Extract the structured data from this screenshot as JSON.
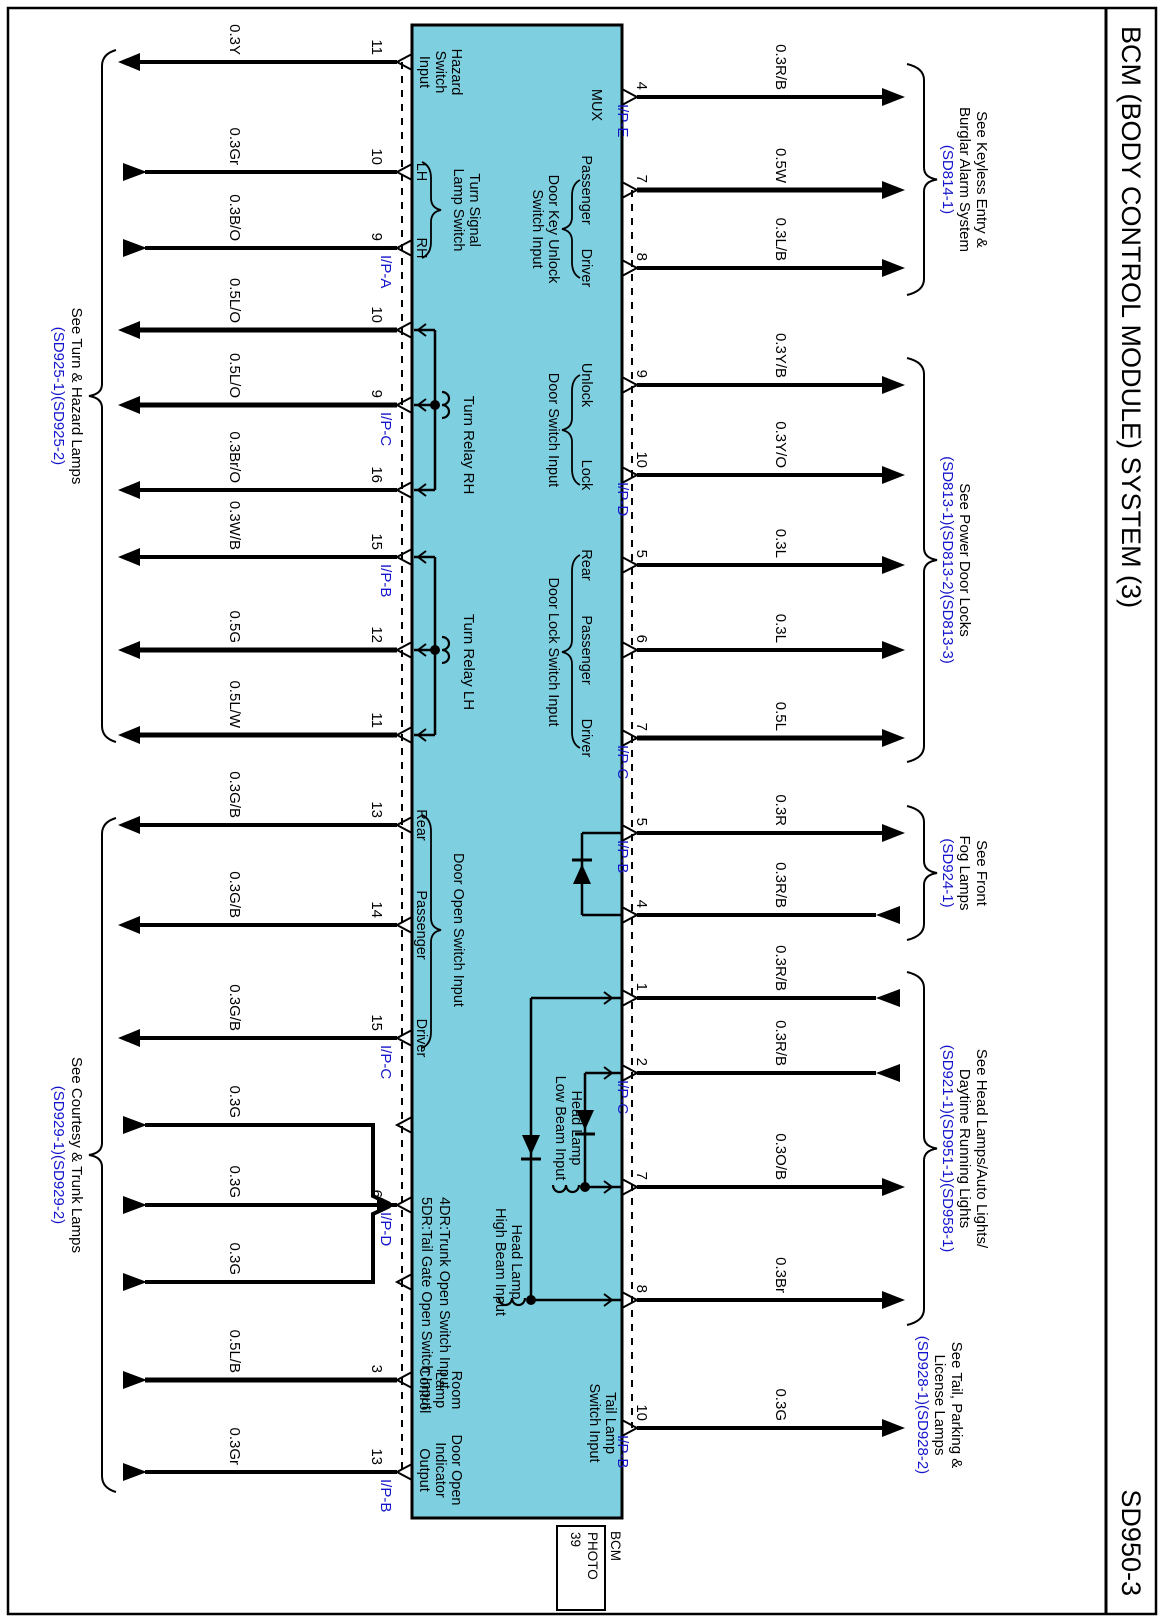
{
  "page": {
    "title": "BCM (BODY CONTROL MODULE) SYSTEM (3)",
    "code": "SD950-3",
    "photo_tag": {
      "above": "BCM",
      "box_lines": [
        "PHOTO",
        "39"
      ]
    }
  },
  "colors": {
    "box_fill": "#7ecfe0",
    "line": "#000000",
    "ref_blue": "#1414cc",
    "paper": "#ffffff"
  },
  "bottom_wires": [
    {
      "x": 62,
      "label": "0.3Y",
      "pin": "11",
      "ip": null,
      "dir": "out"
    },
    {
      "x": 172,
      "label": "0.3Gr",
      "pin": "10",
      "ip": null,
      "dir": "in"
    },
    {
      "x": 248,
      "label": "0.3B/O",
      "pin": "9",
      "ip": "I/P-A",
      "dir": "in"
    },
    {
      "x": 330,
      "label": "0.5L/O",
      "pin": "10",
      "ip": null,
      "dir": "out"
    },
    {
      "x": 405,
      "label": "0.5L/O",
      "pin": "9",
      "ip": "I/P-C",
      "dir": "out"
    },
    {
      "x": 490,
      "label": "0.3Br/O",
      "pin": "16",
      "ip": null,
      "dir": "out"
    },
    {
      "x": 557,
      "label": "0.3W/B",
      "pin": "15",
      "ip": "I/P-B",
      "dir": "out"
    },
    {
      "x": 650,
      "label": "0.5G",
      "pin": "12",
      "ip": null,
      "dir": "out"
    },
    {
      "x": 735,
      "label": "0.5L/W",
      "pin": "11",
      "ip": null,
      "dir": "out"
    },
    {
      "x": 825,
      "label": "0.3G/B",
      "pin": "13",
      "ip": null,
      "dir": "out"
    },
    {
      "x": 925,
      "label": "0.3G/B",
      "pin": "14",
      "ip": null,
      "dir": "out"
    },
    {
      "x": 1038,
      "label": "0.3G/B",
      "pin": "15",
      "ip": "I/P-C",
      "dir": "out"
    },
    {
      "x": 1125,
      "label": "0.3G",
      "pin": null,
      "ip": null,
      "dir": "in",
      "join": "left"
    },
    {
      "x": 1205,
      "label": "0.3G",
      "pin": "6",
      "ip": "I/P-D",
      "dir": "in",
      "join": "mid"
    },
    {
      "x": 1282,
      "label": "0.3G",
      "pin": null,
      "ip": null,
      "dir": "in",
      "join": "right"
    },
    {
      "x": 1380,
      "label": "0.5L/B",
      "pin": "3",
      "ip": null,
      "dir": "in"
    },
    {
      "x": 1472,
      "label": "0.3Gr",
      "pin": "13",
      "ip": "I/P-B",
      "dir": "in"
    }
  ],
  "top_wires": [
    {
      "x": 97,
      "label": "0.3R/B",
      "pin": "4",
      "ip": "I/P-E",
      "dir": "out"
    },
    {
      "x": 190,
      "label": "0.5W",
      "pin": "7",
      "ip": null,
      "dir": "out"
    },
    {
      "x": 268,
      "label": "0.3L/B",
      "pin": "8",
      "ip": null,
      "dir": "out"
    },
    {
      "x": 385,
      "label": "0.3Y/B",
      "pin": "9",
      "ip": null,
      "dir": "out"
    },
    {
      "x": 475,
      "label": "0.3Y/O",
      "pin": "10",
      "ip": "I/P-D",
      "dir": "out"
    },
    {
      "x": 565,
      "label": "0.3L",
      "pin": "5",
      "ip": null,
      "dir": "out"
    },
    {
      "x": 650,
      "label": "0.3L",
      "pin": "6",
      "ip": null,
      "dir": "out"
    },
    {
      "x": 738,
      "label": "0.5L",
      "pin": "7",
      "ip": "I/P-C",
      "dir": "out"
    },
    {
      "x": 833,
      "label": "0.3R",
      "pin": "5",
      "ip": "I/P-B",
      "dir": "out"
    },
    {
      "x": 915,
      "label": "0.3R/B",
      "pin": "4",
      "ip": null,
      "dir": "in"
    },
    {
      "x": 998,
      "label": "0.3R/B",
      "pin": "1",
      "ip": null,
      "dir": "in"
    },
    {
      "x": 1073,
      "label": "0.3R/B",
      "pin": "2",
      "ip": "I/P-C",
      "dir": "in"
    },
    {
      "x": 1187,
      "label": "0.3O/B",
      "pin": "7",
      "ip": null,
      "dir": "out"
    },
    {
      "x": 1300,
      "label": "0.3Br",
      "pin": "8",
      "ip": null,
      "dir": "out"
    },
    {
      "x": 1428,
      "label": "0.3G",
      "pin": "10",
      "ip": "I/P-B",
      "dir": "out"
    }
  ],
  "top_braces": [
    {
      "x1": 64,
      "x2": 295,
      "lines": [
        "See Keyless Entry &",
        "Burglar Alarm System"
      ],
      "refs": [
        "(SD814-1)"
      ]
    },
    {
      "x1": 358,
      "x2": 762,
      "lines": [
        "See Power Door Locks"
      ],
      "refs": [
        "(SD813-1)(SD813-2)(SD813-3)"
      ]
    },
    {
      "x1": 806,
      "x2": 940,
      "lines": [
        "See Front",
        "Fog Lamps"
      ],
      "refs": [
        "(SD924-1)"
      ]
    },
    {
      "x1": 972,
      "x2": 1325,
      "lines": [
        "See Head Lamps/Auto Lights/",
        "Daytime Running Lights"
      ],
      "refs": [
        "(SD921-1)(SD951-1)(SD958-1)"
      ]
    }
  ],
  "top_plain_labels": [
    {
      "cx": 1405,
      "lines": [
        "See Tail, Parking &",
        "License Lamps"
      ],
      "refs": [
        "(SD928-1)(SD928-2)"
      ]
    }
  ],
  "bottom_braces": [
    {
      "x1": 50,
      "x2": 742,
      "lines": [
        "See Turn & Hazard Lamps"
      ],
      "refs": [
        "(SD925-1)(SD925-2)"
      ]
    },
    {
      "x1": 818,
      "x2": 1492,
      "lines": [
        "See Courtesy & Trunk Lamps"
      ],
      "refs": [
        "(SD929-1)(SD929-2)"
      ]
    }
  ],
  "box_top_groups": [
    {
      "type": "plain",
      "cx": 105,
      "names": [],
      "label": [
        "MUX"
      ],
      "label_y": 572
    },
    {
      "type": "brace",
      "cx": 229,
      "names": [
        {
          "x": 190,
          "t": "Passenger"
        },
        {
          "x": 268,
          "t": "Driver"
        }
      ],
      "bx1": 180,
      "bx2": 278,
      "label": [
        "Door Key Unlock",
        "Switch Input"
      ]
    },
    {
      "type": "brace",
      "cx": 430,
      "names": [
        {
          "x": 385,
          "t": "Unlock"
        },
        {
          "x": 475,
          "t": "Lock"
        }
      ],
      "bx1": 375,
      "bx2": 485,
      "label": [
        "Door Switch Input"
      ]
    },
    {
      "type": "brace",
      "cx": 652,
      "names": [
        {
          "x": 565,
          "t": "Rear"
        },
        {
          "x": 650,
          "t": "Passenger"
        },
        {
          "x": 738,
          "t": "Driver"
        }
      ],
      "bx1": 555,
      "bx2": 748,
      "label": [
        "Door Lock Switch Input"
      ]
    },
    {
      "type": "plain2",
      "cx": 1423,
      "names": [],
      "label": [
        "Tail Lamp",
        "Switch Input"
      ]
    }
  ],
  "box_bottom_groups": [
    {
      "type": "stack3",
      "cx": 72,
      "label": [
        "Hazard",
        "Switch",
        "Input"
      ]
    },
    {
      "type": "brace",
      "cx": 210,
      "names": [
        {
          "x": 172,
          "t": "LH"
        },
        {
          "x": 248,
          "t": "RH"
        }
      ],
      "bx1": 162,
      "bx2": 258,
      "label": [
        "Turn Signal",
        "Lamp Switch"
      ]
    },
    {
      "type": "brace",
      "cx": 930,
      "names": [
        {
          "x": 825,
          "t": "Rear"
        },
        {
          "x": 925,
          "t": "Passenger"
        },
        {
          "x": 1038,
          "t": "Driver"
        }
      ],
      "bx1": 815,
      "bx2": 1048,
      "label": [
        "Door Open Switch Input"
      ]
    },
    {
      "type": "left2",
      "lx": 1197,
      "label": [
        "4DR:Trunk Open Switch Input",
        "5DR:Tail Gate Open Switch Input"
      ]
    },
    {
      "type": "stack3",
      "cx": 1390,
      "label": [
        "Room",
        "Lamp",
        "Control"
      ]
    },
    {
      "type": "stack3",
      "cx": 1470,
      "label": [
        "Door Open",
        "Indicator",
        "Output"
      ]
    }
  ],
  "relays": [
    {
      "pins": [
        330,
        405,
        490
      ],
      "coil": 405,
      "label": "Turn Relay RH",
      "lx": 445
    },
    {
      "pins": [
        557,
        650,
        735
      ],
      "coil": 650,
      "label": "Turn Relay LH",
      "lx": 662
    }
  ],
  "fog_diode": {
    "x1": 833,
    "x2": 915,
    "y": 582
  },
  "headlamp": {
    "low": {
      "pin_in": 1073,
      "pin_out": 1187,
      "y": 579,
      "diode_x": 1120,
      "label": [
        "Head Lamp",
        "Low Beam Input"
      ],
      "label_cx": 1128,
      "label_y": 592
    },
    "high": {
      "pin_in": 998,
      "pin_out": 1300,
      "y": 633,
      "diode_x": 1145,
      "label": [
        "Head Lamp",
        "High Beam Input"
      ],
      "label_cx": 1262,
      "label_y": 652
    }
  }
}
